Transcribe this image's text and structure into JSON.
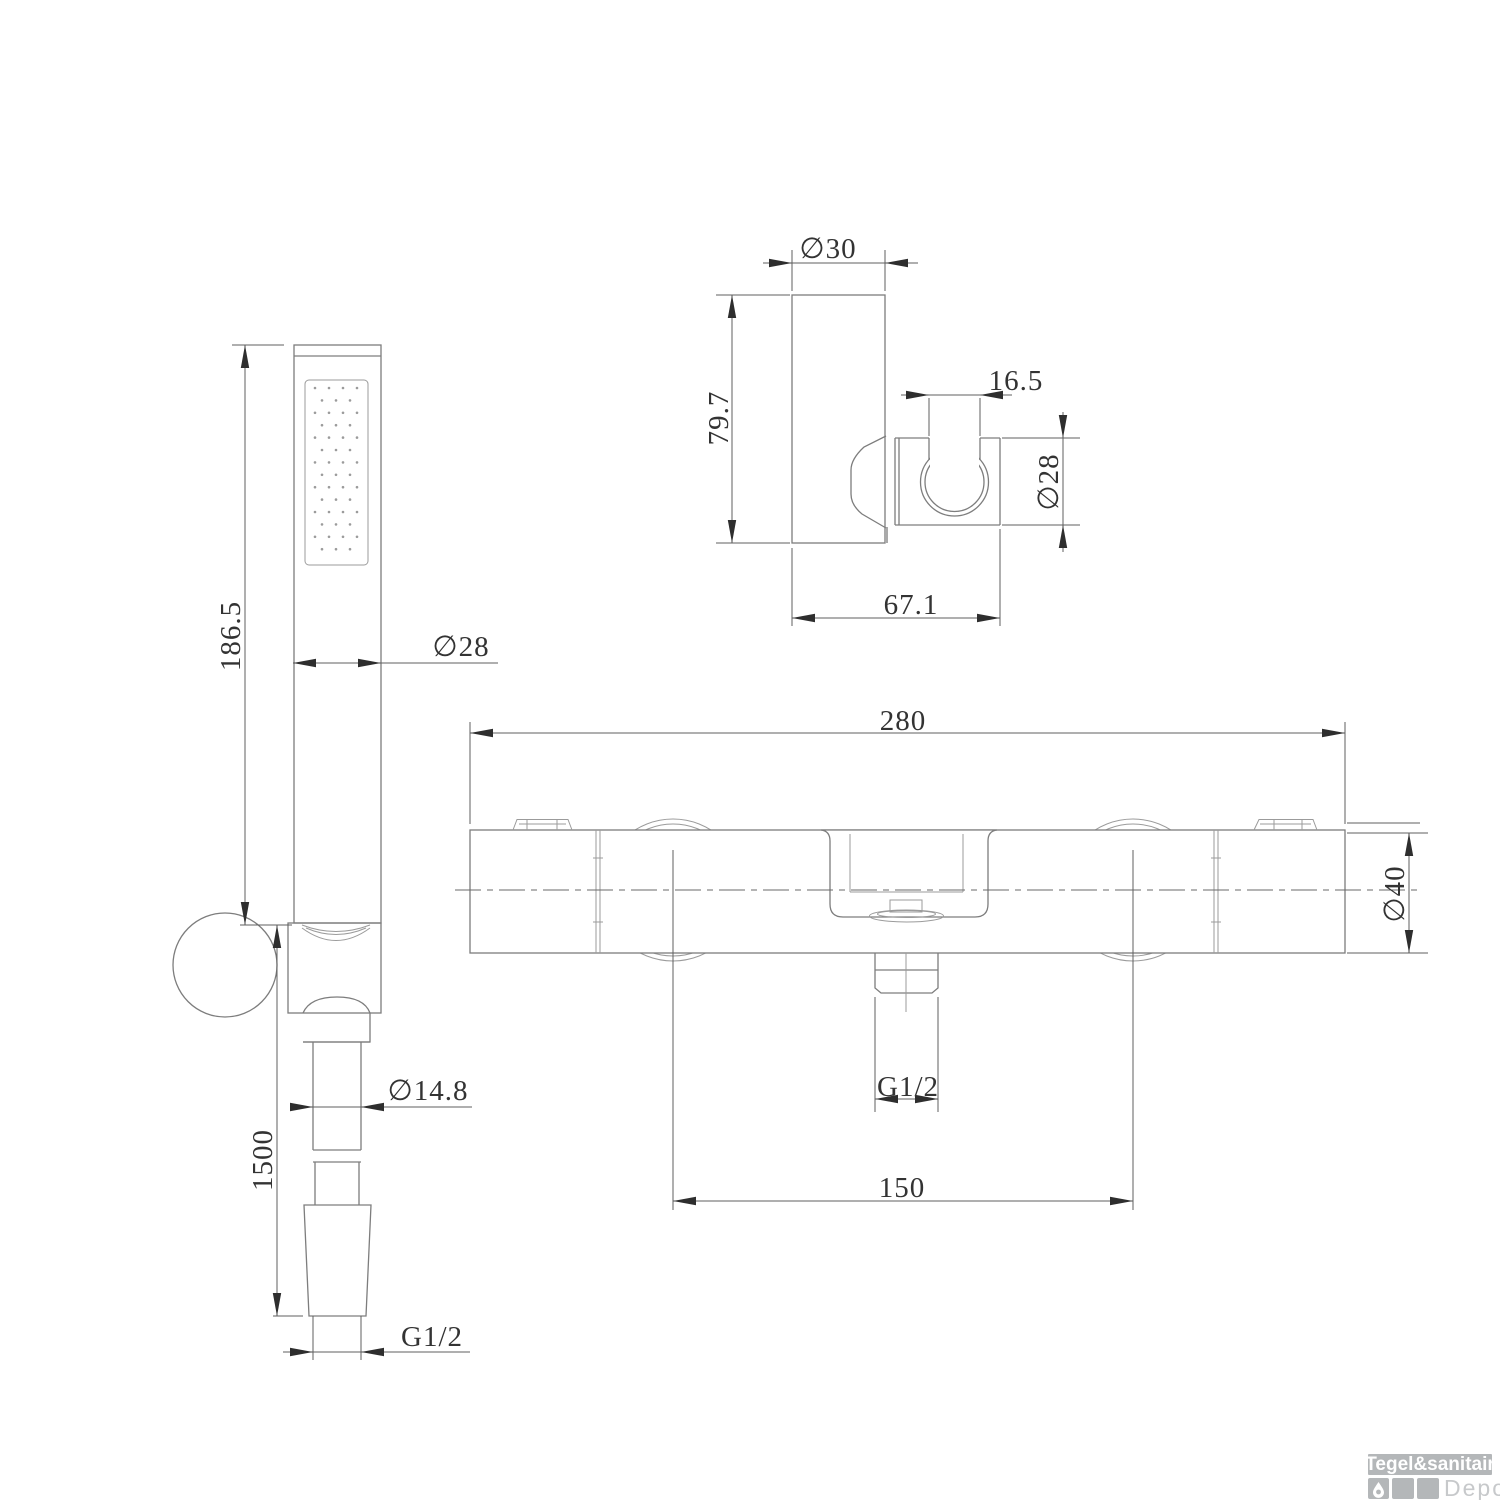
{
  "drawing": {
    "views": {
      "hand_shower": {
        "length": "186.5",
        "head_diameter": "∅28",
        "hose_diameter": "∅14.8",
        "hose_length": "1500",
        "thread": "G1/2"
      },
      "wall_bracket": {
        "width_diameter": "∅30",
        "height": "79.7",
        "clip_opening": "16.5",
        "clip_diameter": "∅28",
        "depth": "67.1"
      },
      "mixer": {
        "total_width": "280",
        "body_diameter": "∅40",
        "outlet_thread": "G1/2",
        "inlet_spacing": "150"
      }
    }
  },
  "watermark": {
    "brand": "Tegel&sanitair",
    "suffix": "Depot",
    "icon": "droplet-icon"
  },
  "colors": {
    "geometry_line": "#7d7d7d",
    "dimension_line": "#5f5f5f",
    "text": "#333333",
    "watermark_gray": "#b4b7b9",
    "watermark_light": "#c7c9cb",
    "background": "#ffffff"
  }
}
